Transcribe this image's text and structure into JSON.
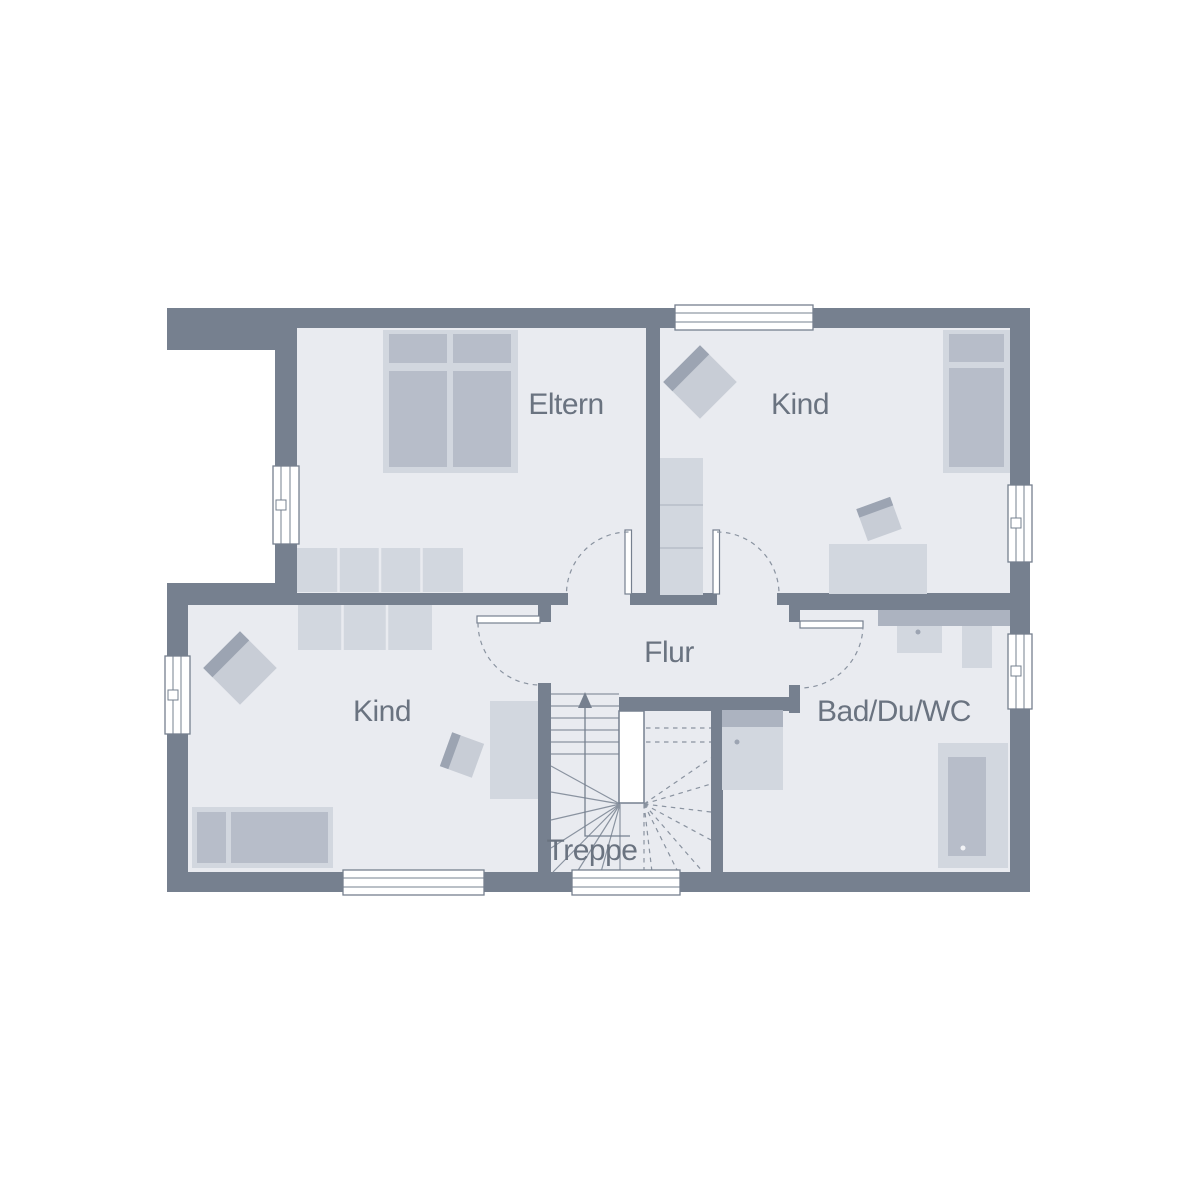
{
  "rooms": [
    {
      "id": "eltern",
      "label": "Eltern"
    },
    {
      "id": "kind_top_right",
      "label": "Kind"
    },
    {
      "id": "kind_bottom_left",
      "label": "Kind"
    },
    {
      "id": "flur",
      "label": "Flur"
    },
    {
      "id": "bad_du_wc",
      "label": "Bad/Du/WC"
    },
    {
      "id": "treppe",
      "label": "Treppe"
    }
  ],
  "colors": {
    "background": "#FFFFFF",
    "wall": "#76808F",
    "floor": "#E9EBF0",
    "furn_light": "#D2D7DF",
    "furn_mid": "#B7BDC9",
    "furn_seat": "#C8CDD6",
    "furn_back": "#9CA4B2",
    "furn_counter": "#ACB3C0",
    "stair_line": "#8A93A0",
    "label_text": "#6A7380"
  }
}
